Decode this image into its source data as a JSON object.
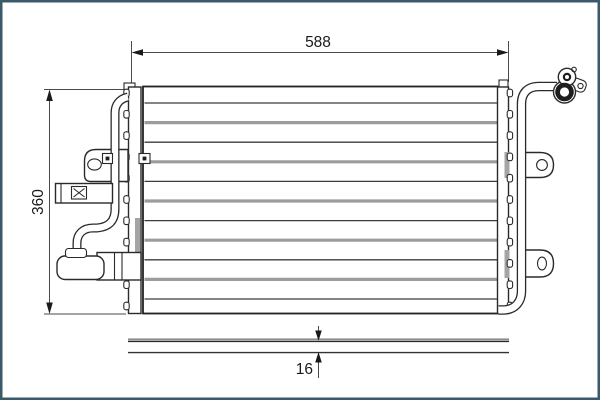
{
  "drawing": {
    "type": "technical-drawing",
    "subject": "condenser-front-and-side-view",
    "dim_width": {
      "label": "588"
    },
    "dim_height": {
      "label": "360"
    },
    "dim_depth": {
      "label": "16"
    },
    "core": {
      "tube_rows": 11,
      "notch_count": 11
    },
    "colors": {
      "frame_border": "#3b5968",
      "line": "#2a2a2a",
      "tube_gray": "#9c9c9c",
      "dimension_line": "#4a4a4a",
      "background": "#ffffff"
    }
  }
}
